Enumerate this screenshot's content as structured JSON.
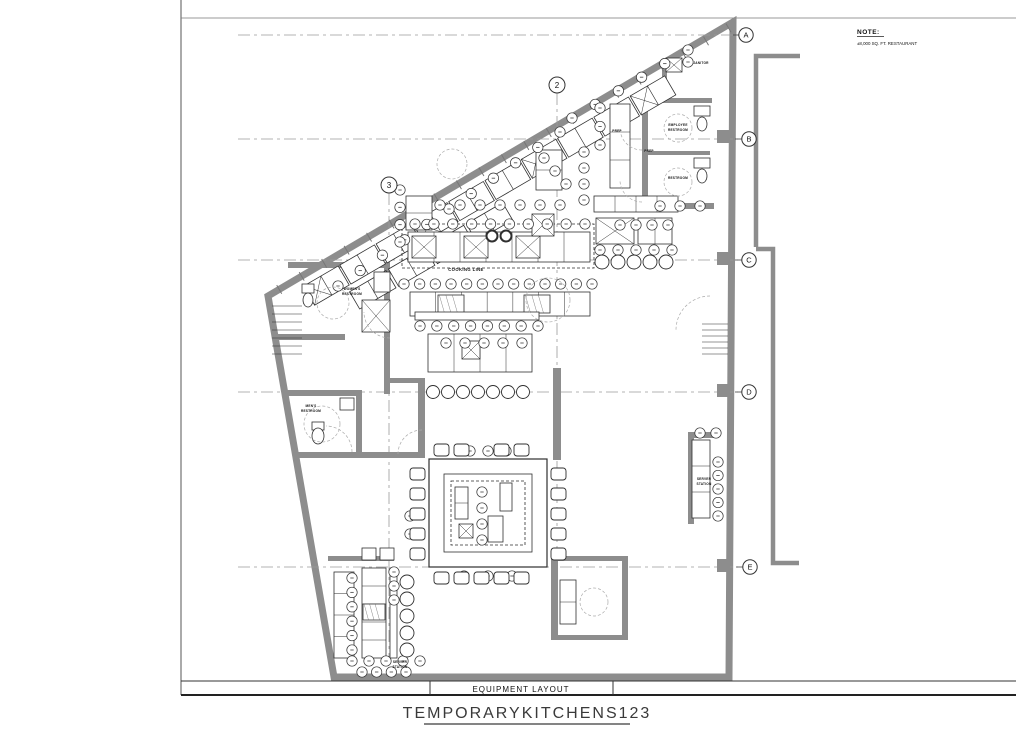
{
  "sheet": {
    "note": {
      "title": "NOTE:",
      "body": "±8,000 SQ. FT. RESTAURANT"
    },
    "drawing_label": "EQUIPMENT LAYOUT",
    "project_title": "TEMPORARYKITCHENS123"
  },
  "grid": {
    "row_bubbles": [
      "A",
      "B",
      "C",
      "D",
      "E"
    ],
    "column_bubbles": [
      "2",
      "3"
    ]
  },
  "labels": {
    "janitor": "JANITOR",
    "employee_restroom_1": "EMPLOYEE",
    "employee_restroom_2": "RESTROOM",
    "restroom": "RESTROOM",
    "prep_a": "PREP",
    "prep_b": "PREP",
    "cooking_line": "COOKING LINE",
    "womens_restroom_1": "WOMEN'S",
    "womens_restroom_2": "RESTROOM",
    "mens_restroom_1": "MEN'S",
    "mens_restroom_2": "RESTROOM",
    "server_station_left_1": "SERVER",
    "server_station_left_2": "STATION",
    "server_station_right_1": "SERVER",
    "server_station_right_2": "STATION"
  },
  "colors": {
    "wall": "#8d8d8d",
    "line": "#2f2f2f",
    "dash": "#9a9a9a"
  }
}
